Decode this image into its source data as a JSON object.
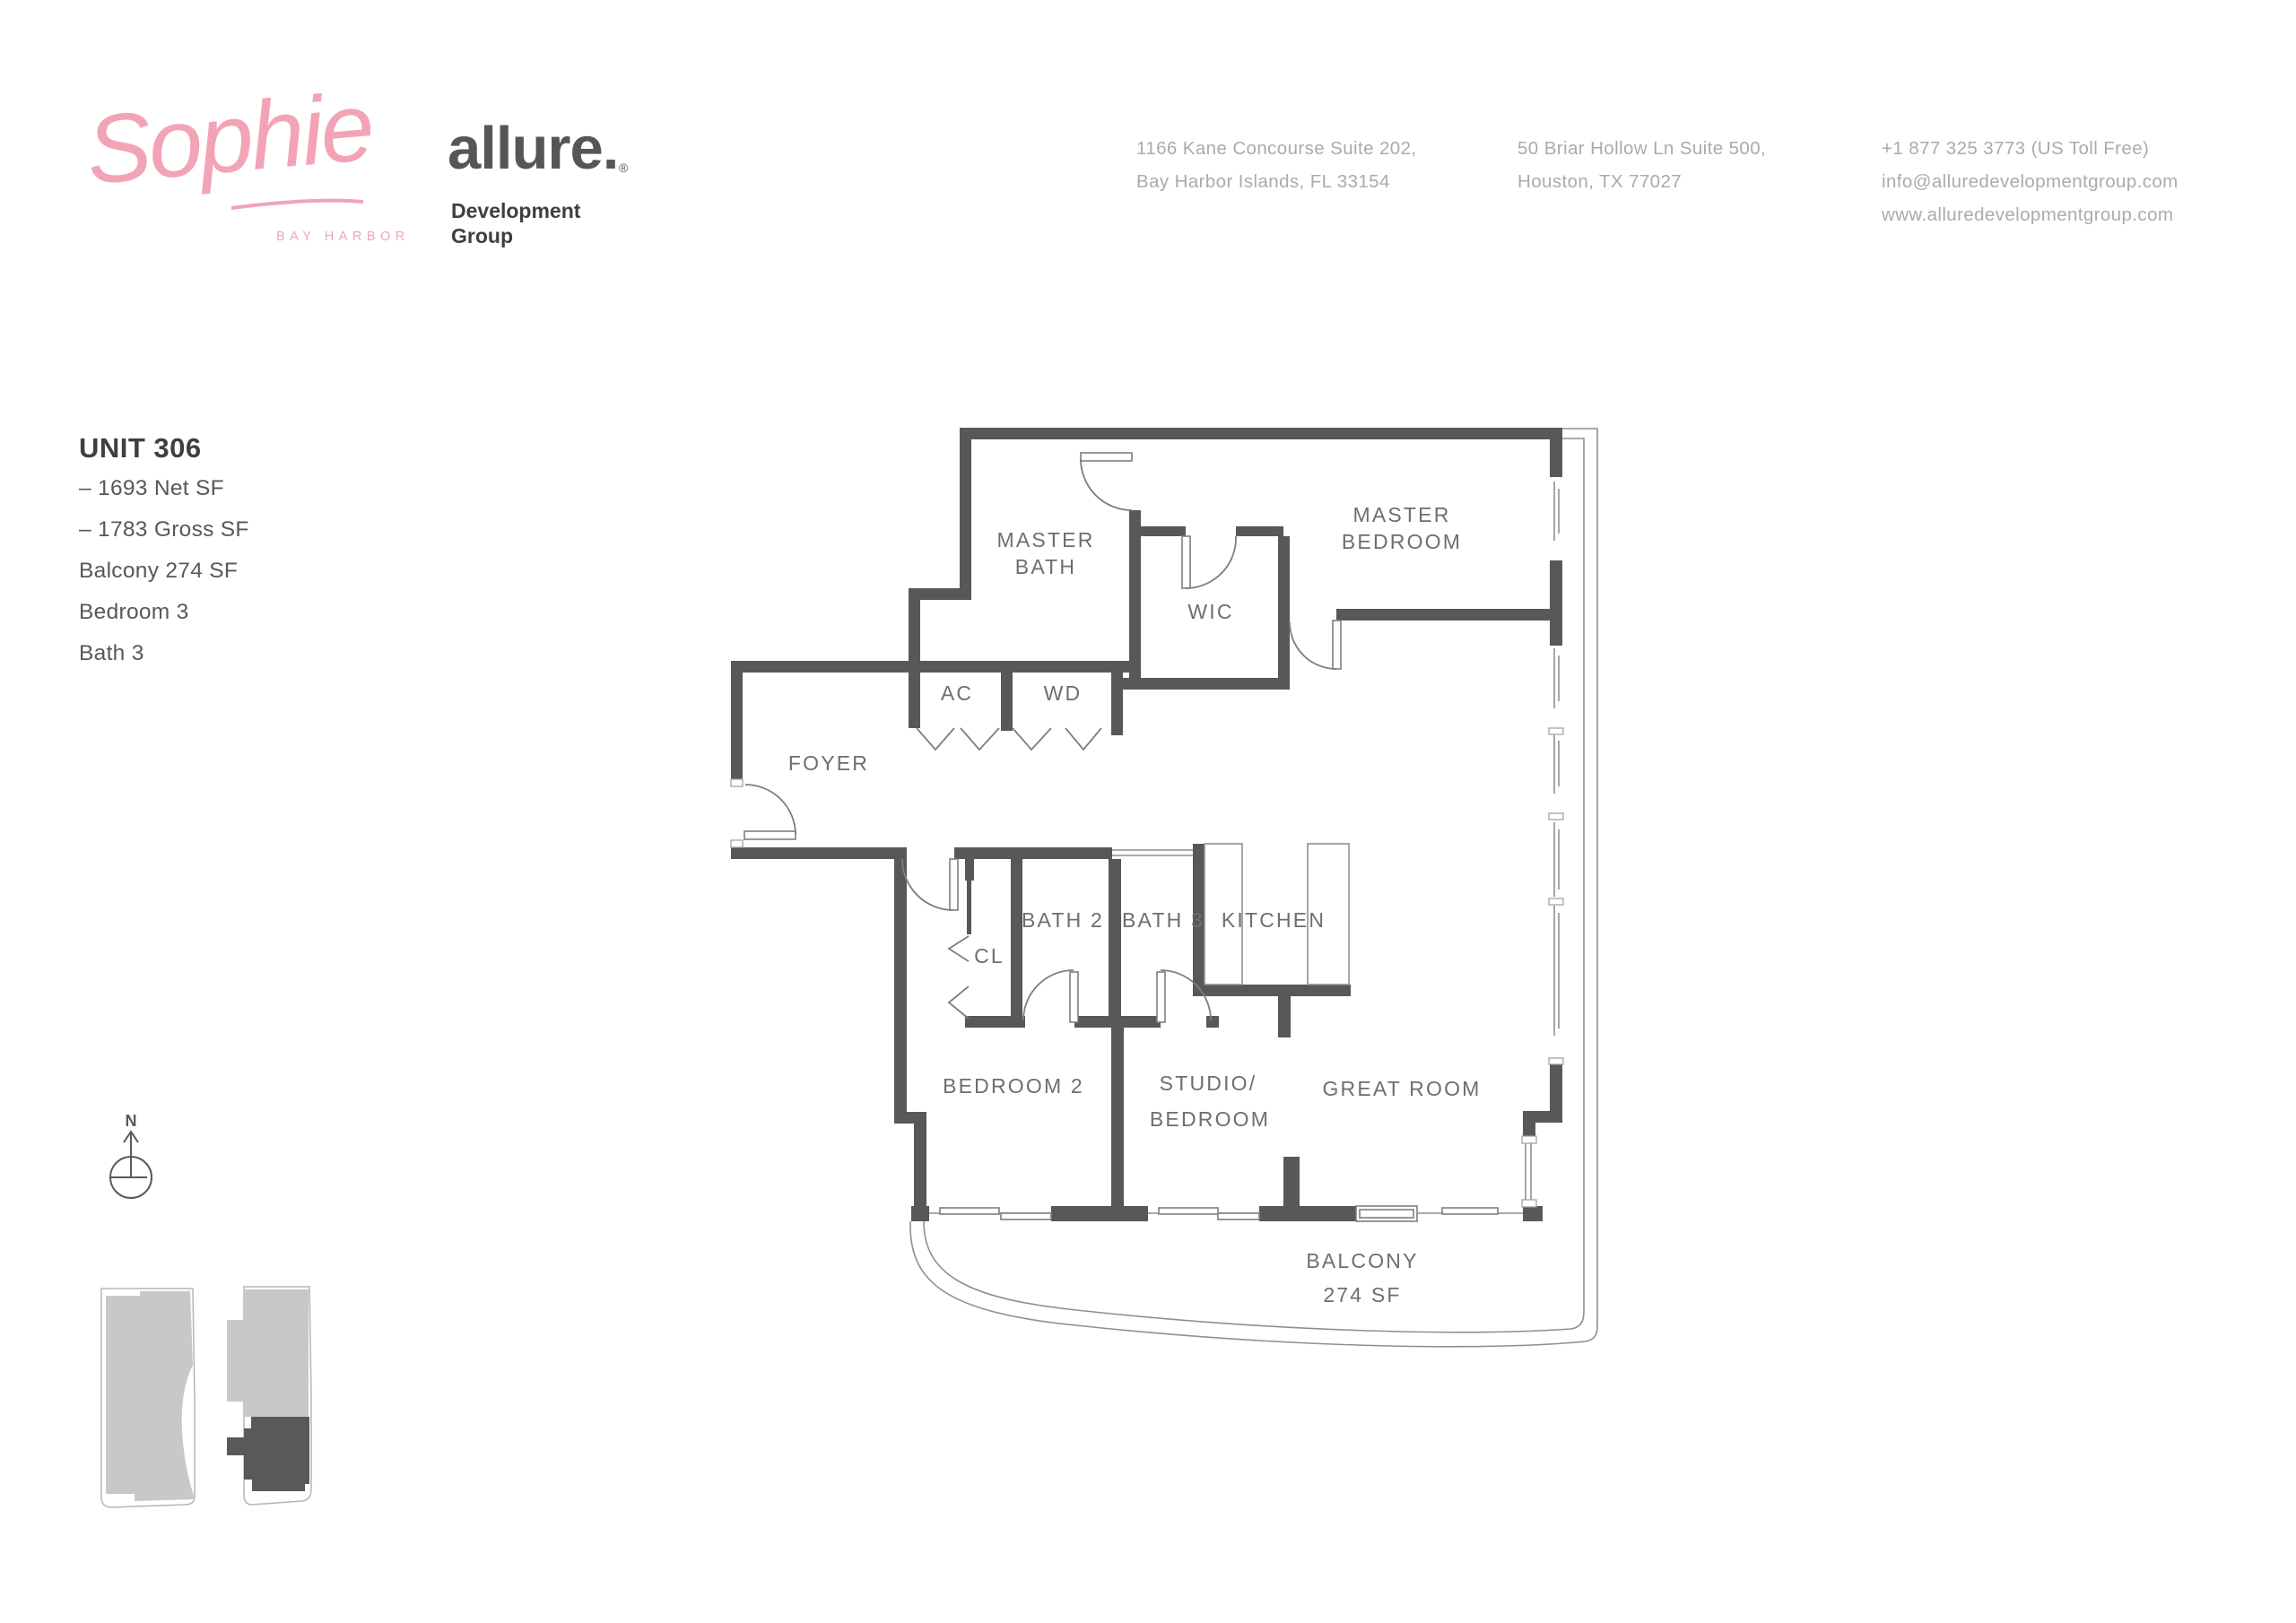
{
  "colors": {
    "brand_pink": "#f2a4b6",
    "wall_gray": "#56585a",
    "label_gray": "#6d6e71",
    "light_text": "#a9abac",
    "dark_text": "#3e3f41",
    "keyplan_light": "#c6c8ca",
    "keyplan_dark": "#58595b"
  },
  "header": {
    "sophie": {
      "script": "Sophie",
      "subtitle": "BAY HARBOR"
    },
    "allure": {
      "name": "allure.",
      "registered": "®",
      "sub1": "Development",
      "sub2": "Group"
    },
    "contact": {
      "address1": [
        "1166 Kane Concourse Suite 202,",
        "Bay Harbor Islands, FL 33154"
      ],
      "address2": [
        "50 Briar Hollow Ln Suite 500,",
        "Houston, TX 77027"
      ],
      "contact3": [
        "+1 877 325 3773 (US Toll Free)",
        "info@alluredevelopmentgroup.com",
        "www.alluredevelopmentgroup.com"
      ]
    }
  },
  "unit": {
    "title": "UNIT 306",
    "specs": [
      "– 1693 Net SF",
      "– 1783 Gross SF",
      "Balcony 274 SF",
      "Bedroom 3",
      "Bath 3"
    ]
  },
  "floorplan": {
    "rooms": {
      "master_bath1": "MASTER",
      "master_bath2": "BATH",
      "wic": "WIC",
      "master_bedroom1": "MASTER",
      "master_bedroom2": "BEDROOM",
      "ac": "AC",
      "wd": "WD",
      "foyer": "FOYER",
      "cl": "CL",
      "bath2": "BATH 2",
      "bath3": "BATH 3",
      "kitchen": "KITCHEN",
      "bedroom2": "BEDROOM 2",
      "studio1": "STUDIO/",
      "studio2": "BEDROOM",
      "great_room": "GREAT ROOM",
      "balcony1": "BALCONY",
      "balcony2": "274 SF"
    }
  },
  "compass": {
    "north": "N"
  }
}
